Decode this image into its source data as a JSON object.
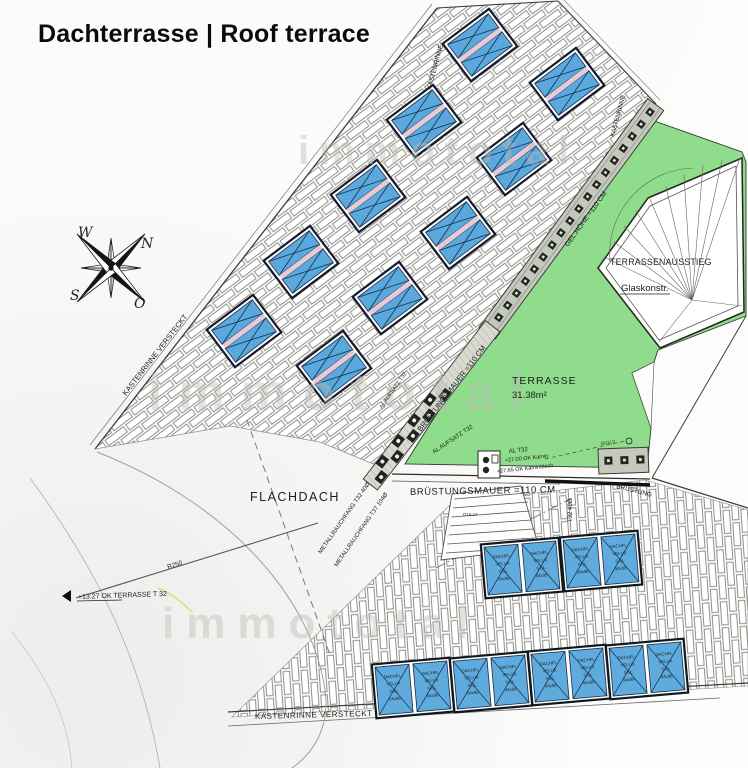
{
  "title": "Dachterrasse | Roof terrace",
  "compass": {
    "w": "W",
    "n": "N",
    "s": "S",
    "o": "O"
  },
  "watermark": {
    "text": "immototal"
  },
  "plan": {
    "terrasse": "TERRASSE",
    "terrasse_area": "31.38m²",
    "flachdach": "FLACHDACH",
    "ausstieg": "TERRASSENAUSSTIEG",
    "glaskonstr": "Glaskonstr.",
    "bruestung_diag": "BRÜSTUNGSMAUER =110 CM",
    "bruestung_horiz": "BRÜSTUNGSMAUER =110 CM",
    "bruestung_right": "BRÜSTUNG",
    "gel_hoehe": "GEL.HÖHE =110 CM",
    "kastenrinne_top": "KASTENRINNE",
    "kastenrinne_right": "KASTENRINNE",
    "kastenrinne_left": "KASTENRINNE VERSTECKT",
    "kastenrinne_bottom": "KASTENRINNE VERSTECKT",
    "level_mark": "+13.27 OK TERRASSE T 32",
    "radius": "R250",
    "rauchfang1": "METALLRAUCHFANG T32 40Ø",
    "rauchfang2": "METALLRAUCHFANG T37 104Ø",
    "aufsatz1": "AL AUFSATZ T32",
    "aufsatz2": "AL AUFSATZ T32",
    "al_t32": "AL T32",
    "kamin_ok": "+27.00 OK Kamin",
    "kamin_blech": "+27.65 OK Kaminblech",
    "t32_40": "T32 40Ø",
    "gully": "GULLY"
  },
  "skylight": {
    "lines": [
      "DACHFL.",
      "VELUX",
      "GGL",
      "94x98"
    ],
    "upper_count": 10,
    "lower_count": 6
  }
}
